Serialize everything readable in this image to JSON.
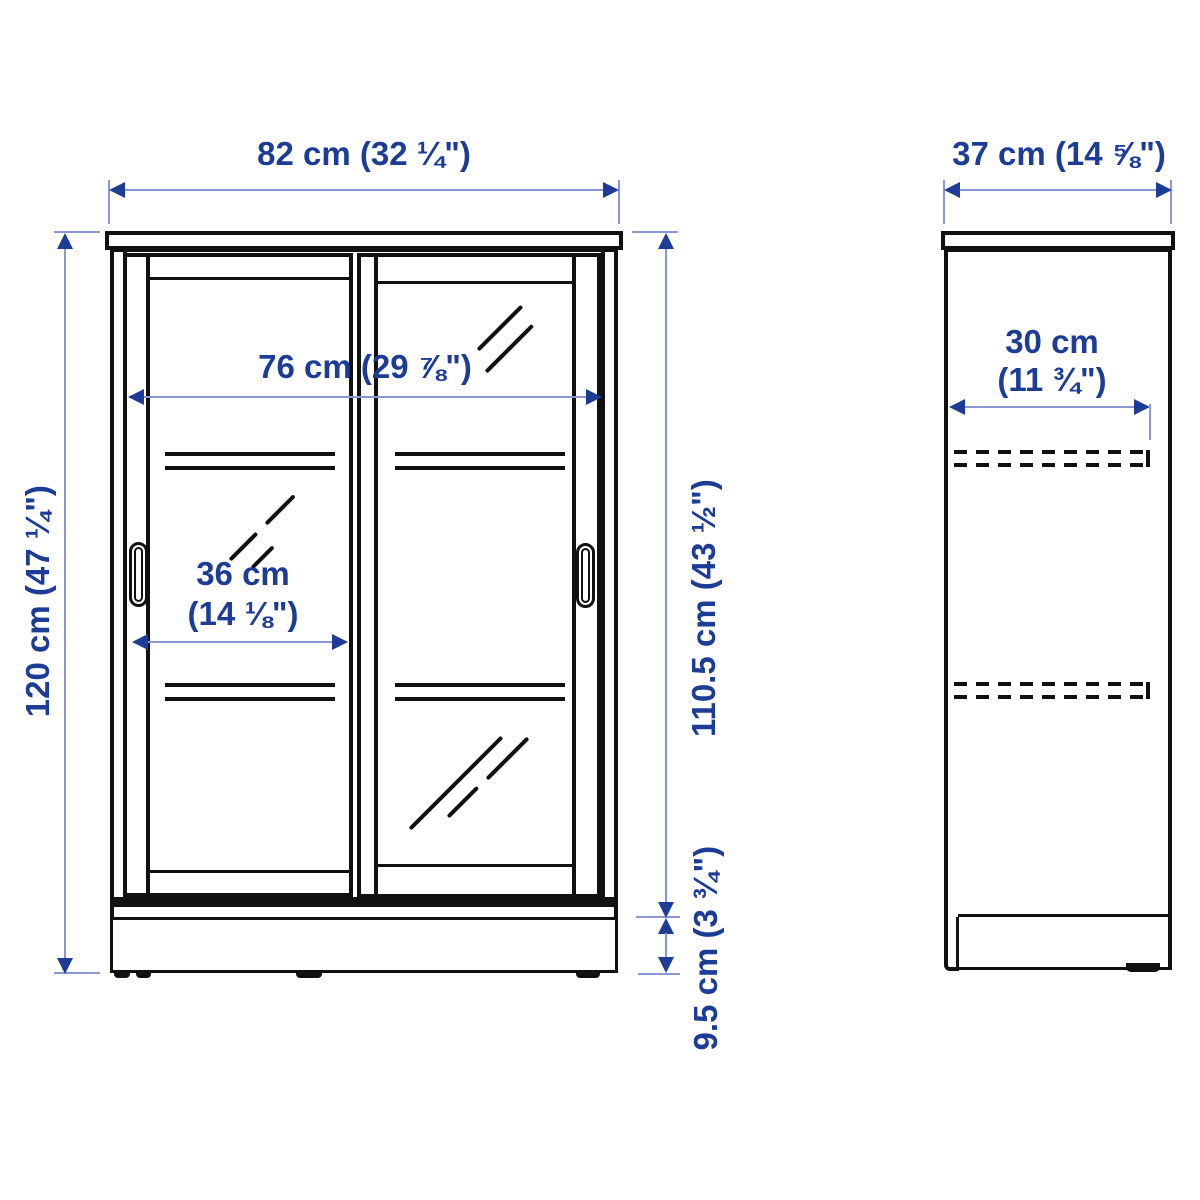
{
  "diagram": {
    "product": "cabinet-with-sliding-glass-doors-dimension-diagram",
    "front_view": {
      "width": "82 cm (32 ¼\")",
      "inner_width": "76 cm (29 ⅞\")",
      "door_width_1": "36 cm",
      "door_width_2": "(14 ⅛\")",
      "height": "120 cm (47 ¼\")",
      "inner_height": "110.5 cm (43 ½\")",
      "base_height": "9.5 cm (3 ¾\")"
    },
    "side_view": {
      "depth": "37 cm (14 ⅝\")",
      "shelf_depth_1": "30 cm",
      "shelf_depth_2": "(11 ¾\")"
    },
    "icons": {
      "arrowhead": "filled-triangle",
      "shelf_hidden_line": "dashed-line",
      "glass_reflection": "diagonal-strokes"
    },
    "colors": {
      "dimension_text": "#1c3c96",
      "dimension_line": "#8a97d0",
      "outline": "#111111",
      "background": "#ffffff"
    }
  }
}
